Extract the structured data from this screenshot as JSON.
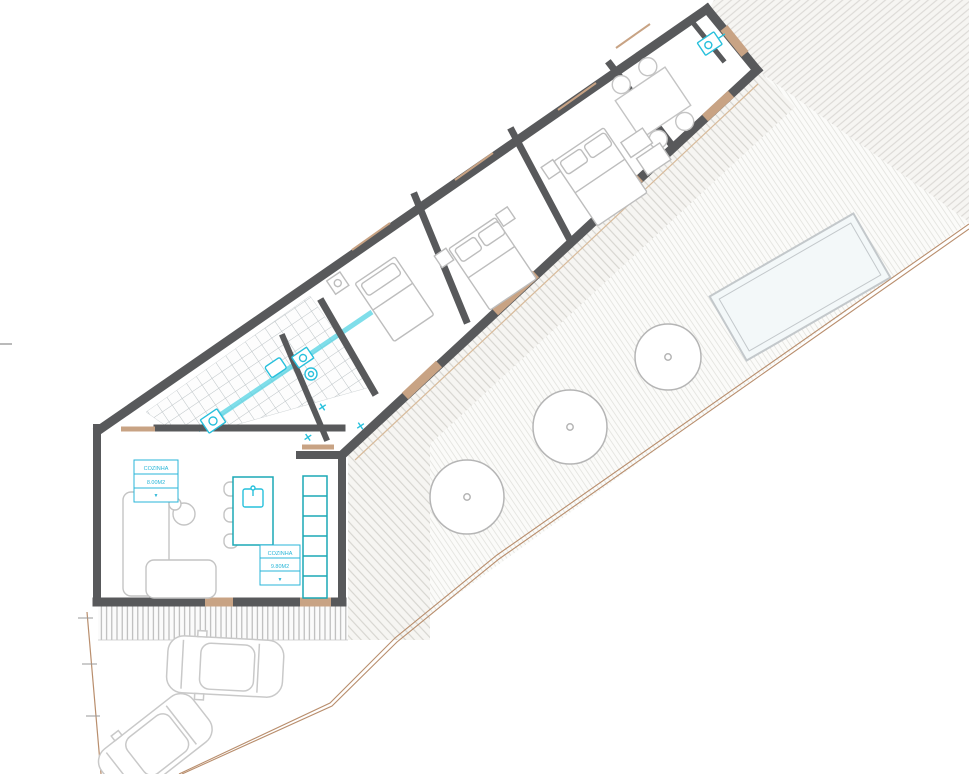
{
  "document": {
    "type": "architectural-floor-plan",
    "view": "top-down site plan of single-storey house with courtyard, pool and parking"
  },
  "labels": {
    "room1": {
      "l1": "COZINHA",
      "l2": "8.00M2",
      "l3": "▼"
    },
    "room2": {
      "l1": "COZINHA",
      "l2": "9.80M2",
      "l3": "▼"
    }
  },
  "colors": {
    "walls": "#58595b",
    "joinery_wood": "#c8a384",
    "plumbing_fixtures_cyan": "#27c0dc",
    "kitchen_teal": "#1ba8b5",
    "furniture_gray": "#c4c4c4",
    "site_boundary_tan": "#b98e6d",
    "tile_grid": "#bcc3c6",
    "label_box_blue": "#29b6d8",
    "pool_fill": "#f3f8f9"
  },
  "inventory": {
    "bedrooms": 3,
    "beds": 3,
    "bathroom_tiled_zones": 2,
    "trees": 3,
    "cars": 2,
    "pools": 1,
    "dining_chairs": 4,
    "bar_stools": 3,
    "label_boxes": 2
  }
}
